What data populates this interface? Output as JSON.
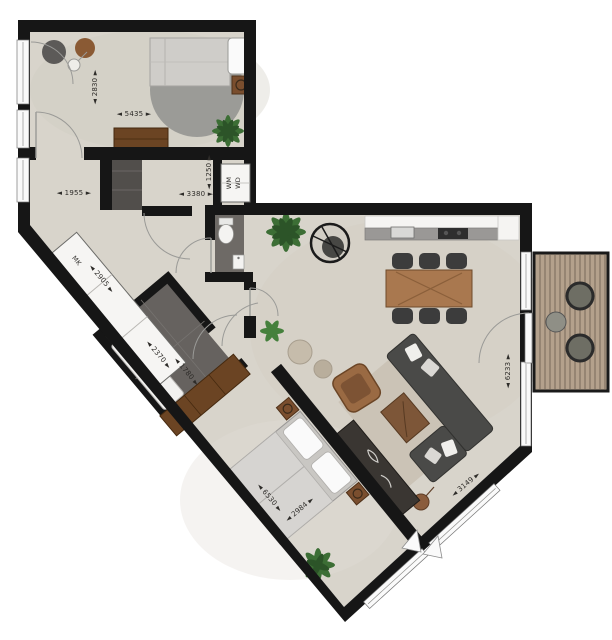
{
  "floorplan": {
    "type": "apartment-floor-plan-top-view",
    "dims": {
      "d2830": "◄ 2830 ►",
      "d5435": "◄ 5435 ►",
      "d1955": "◄ 1955 ►",
      "d3380": "◄ 3380 ►",
      "d1250": "◄ 1250 ►",
      "d2905": "◄ 2905 ►",
      "d2370": "◄ 2370 ►",
      "d1780": "◄ 1780 ►",
      "d6530": "◄ 6530 ►",
      "d2984": "◄ 2984 ►",
      "d6233": "◄ 6233 ►",
      "d3149": "◄ 3149 ►"
    },
    "dimension_values_mm": [
      2830,
      5435,
      1955,
      3380,
      1250,
      2905,
      2370,
      1780,
      6530,
      2984,
      6233,
      3149
    ],
    "labels": {
      "wm": "WM",
      "wd": "WD",
      "mk": "MK"
    },
    "colors": {
      "wall": "#161616",
      "floor": "#d8d4cb",
      "wet_floor": "#6e6a66",
      "closet": "#514e4b",
      "wood_dark": "#6b4423",
      "wood_mid": "#8a5a34",
      "wood_table": "#a9784f",
      "round_rug": "#9b9b97",
      "living_rug": "#cbc3b6",
      "sofa": "#4a4a48",
      "balcony_deck": "#b4a18c",
      "plant_green": "#3c6e35",
      "window_white": "#fafafa"
    }
  }
}
